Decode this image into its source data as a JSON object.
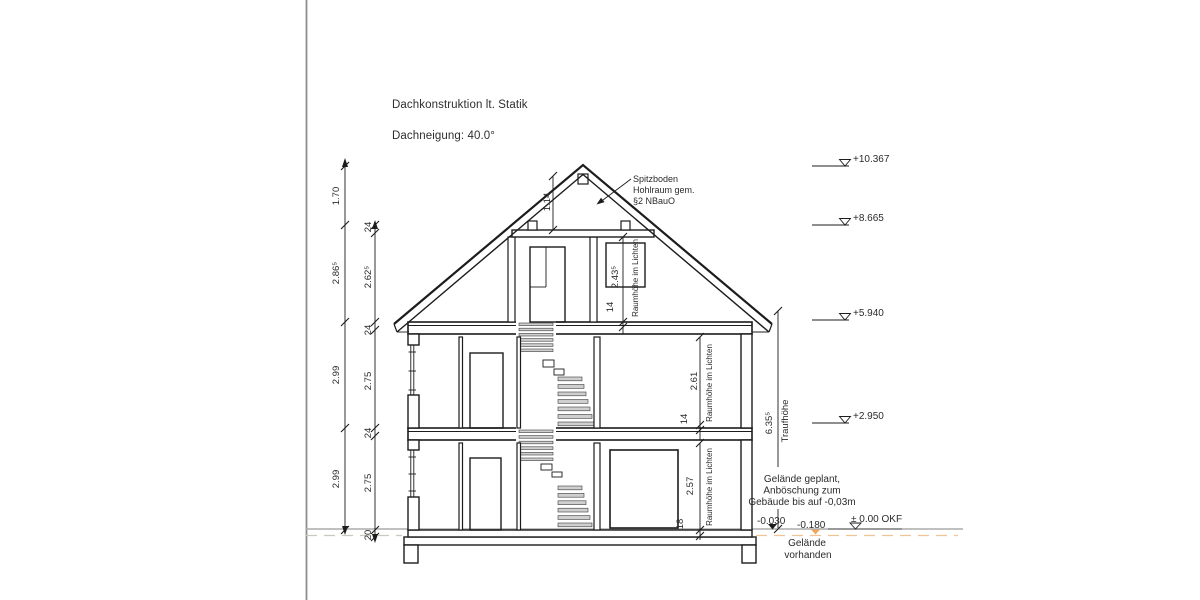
{
  "page": {
    "notes": [
      "Dachkonstruktion lt. Statik",
      "Dachneigung: 40.0°"
    ]
  },
  "attic_note": [
    "Spitzboden",
    "Hohlraum gem.",
    "§2 NBauO"
  ],
  "dimensions": {
    "outer_chain": [
      "1.70",
      "2.86⁵",
      "2.99",
      "2.99"
    ],
    "inner_chain": [
      "24",
      "2.62⁵",
      "24",
      "2.75",
      "24",
      "2.75",
      "20"
    ],
    "ridge_height": "1.14",
    "eaves": {
      "value": "6.35⁵",
      "label": "Traufhöhe"
    },
    "rooms": {
      "dg": {
        "clear_height": "2.43⁵",
        "slab": "14",
        "label": "Raumhöhe im Lichten"
      },
      "og": {
        "clear_height": "2.61",
        "slab": "14",
        "label": "Raumhöhe im Lichten"
      },
      "eg": {
        "clear_height": "2.57",
        "slab": "18",
        "label": "Raumhöhe im Lichten"
      }
    }
  },
  "elevation_marks": [
    {
      "label": "+10.367"
    },
    {
      "label": "+8.665"
    },
    {
      "label": "+5.940"
    },
    {
      "label": "+2.950"
    }
  ],
  "ground": {
    "planned_note": [
      "Gelände geplant,",
      "Anböschung zum",
      "Gebäude bis auf -0,03m"
    ],
    "level_planned": "-0.030",
    "level_existing": "-0.180",
    "level_zero": "± 0.00 OKF",
    "existing_label": [
      "Gelände",
      "vorhanden"
    ]
  },
  "colors": {
    "existing_terrain": "#eda763",
    "existing_terrain_light": "#f2c493",
    "ground_line": "#ababab",
    "drawing": "#1c1c1c"
  }
}
